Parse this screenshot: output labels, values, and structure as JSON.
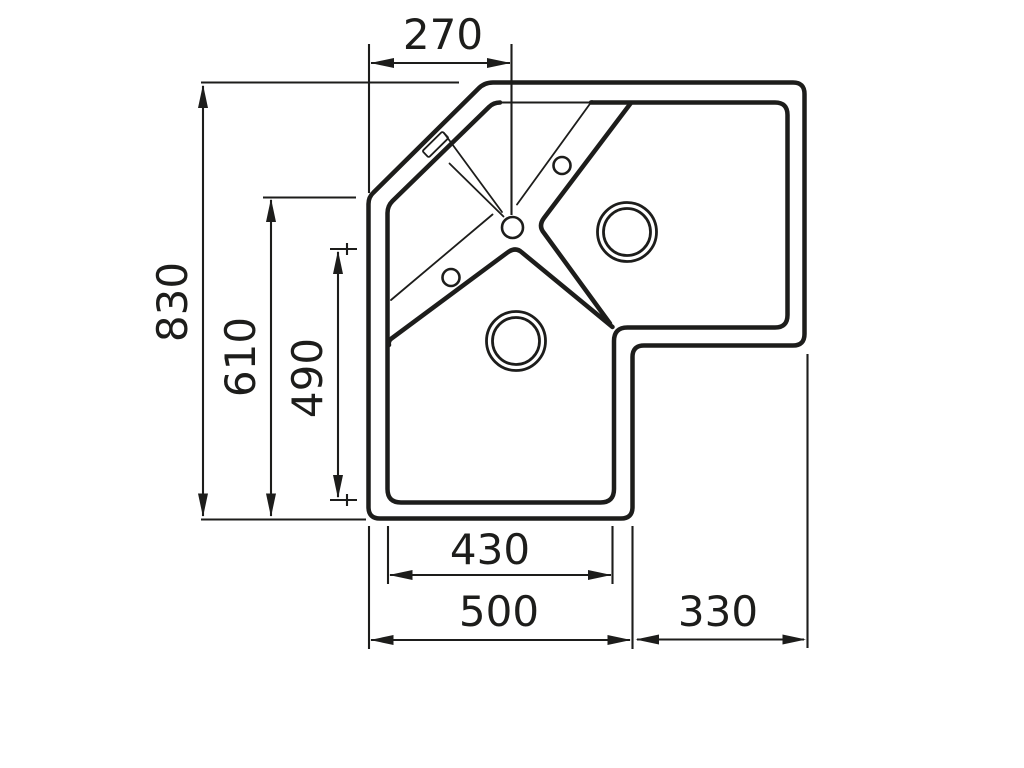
{
  "diagram": {
    "subject": "corner-sink-top-view-technical-drawing",
    "background_color": "#ffffff",
    "line_color": "#1d1d1b",
    "dimension_labels": {
      "corner_top_width": "270",
      "overall_left_height": "830",
      "left_inner_height": "610",
      "bowl_inner_height": "490",
      "bowl_inner_width": "430",
      "bottom_outer_width": "500",
      "right_outer_width": "330"
    }
  }
}
